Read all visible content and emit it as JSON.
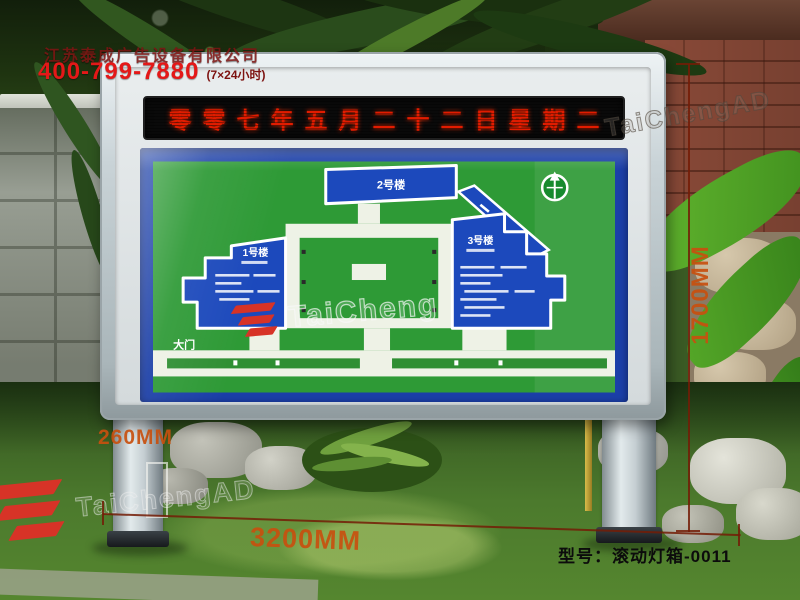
{
  "header": {
    "company_name": "江苏泰成广告设备有限公司",
    "phone": "400-799-7880",
    "phone_hours": "(7×24小时)"
  },
  "lightbox": {
    "led_date_text": "零零七年五月二十二日星期二",
    "map": {
      "building_1": "1号楼",
      "building_2": "2号楼",
      "building_3": "3号楼",
      "gate": "大门",
      "compass_icon": "north-arrow"
    }
  },
  "annotations": {
    "height": "1700MM",
    "depth": "260MM",
    "width": "3200MM",
    "model": "型号：滚动灯箱-0011"
  },
  "watermarks": {
    "map_text": "TaiCheng",
    "top_right_text": "TaiChengAD",
    "bottom_left_text": "TaiChengAD",
    "logo": "TC"
  },
  "colors": {
    "led_red": "#e11c00",
    "map_green": "#2e9a36",
    "map_blue": "#1b3fa8",
    "building_blue": "#1c49bc",
    "dim_orange": "#c8500f",
    "phone_red": "#e41818",
    "logo_red": "#d73327",
    "frame_silver": "#c8d2d6"
  }
}
